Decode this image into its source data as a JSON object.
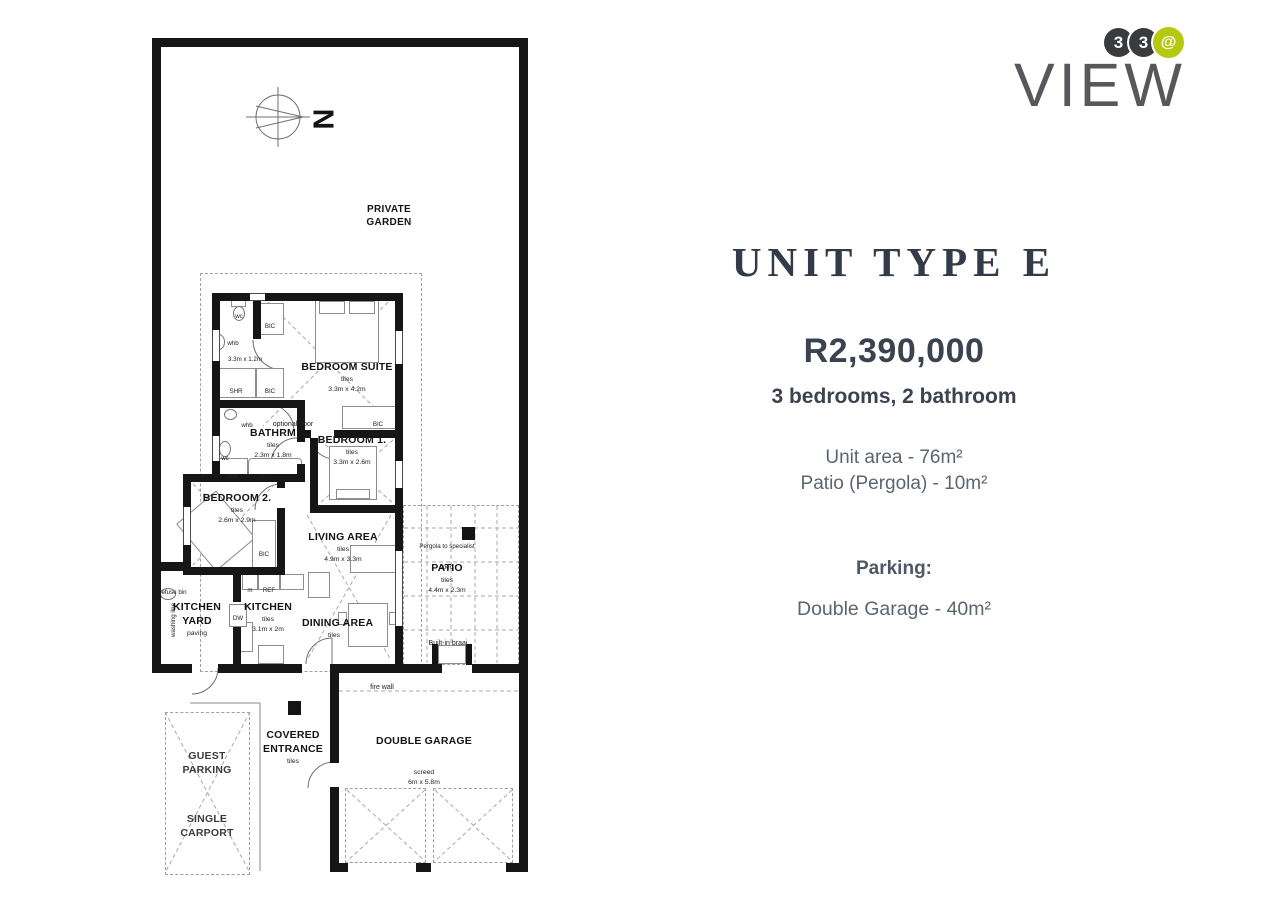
{
  "logo": {
    "badge1": "3",
    "badge2": "3",
    "badge3": "@",
    "name": "VIEW",
    "colors": {
      "dark": "#3a3b3d",
      "lime": "#b5c90f",
      "gray": "#56585c"
    }
  },
  "panel": {
    "title": "UNIT TYPE E",
    "price": "R2,390,000",
    "config": "3 bedrooms, 2 bathroom",
    "unit_area": "Unit area - 76m²",
    "patio_area": "Patio (Pergola) - 10m²",
    "parking_label": "Parking:",
    "parking_value": "Double Garage - 40m²"
  },
  "plan": {
    "compass": "N",
    "garden": "PRIVATE GARDEN",
    "fire_wall": "fire wall",
    "optional_door": "optional door",
    "rooms": {
      "suite": {
        "name": "BEDROOM SUITE",
        "finish": "tiles",
        "dim": "3.3m x 4.2m"
      },
      "ensuite": {
        "wc": "wc",
        "whb": "whb",
        "dim": "3.3m x 1.2m",
        "shr": "SHR",
        "bic": "BIC",
        "bic_top": "BIC"
      },
      "bathroom": {
        "name": "BATHRM",
        "finish": "tiles",
        "dim": "2.3m x 1.8m",
        "whb": "whb",
        "wc": "wc",
        "shr": "SHR",
        "bath": "B"
      },
      "bedroom1": {
        "name": "BEDROOM 1.",
        "finish": "tiles",
        "dim": "3.3m x 2.6m",
        "bic": "BIC"
      },
      "bedroom2": {
        "name": "BEDROOM 2.",
        "finish": "tiles",
        "dim": "2.6m x 2.9m",
        "bic": "BIC"
      },
      "living": {
        "name": "LIVING AREA",
        "finish": "tiles",
        "dim": "4.9m x 3.3m"
      },
      "dining": {
        "name": "DINING AREA",
        "finish": "tiles"
      },
      "kitchen": {
        "name": "KITCHEN",
        "finish": "tiles",
        "dim": "3.1m x 2m",
        "ref": "REF",
        "micro": "m",
        "dw": "DW"
      },
      "yard": {
        "name": "KITCHEN YARD",
        "finish": "paving",
        "refuse": "refuse bin",
        "washing": "washing line"
      },
      "patio": {
        "name": "PATIO",
        "finish": "tiles",
        "dim": "4.4m x 2.3m",
        "pergola": "Pergola to specialist spec.",
        "braai": "Built-in braai"
      },
      "garage": {
        "name": "DOUBLE GARAGE",
        "finish": "screed",
        "dim": "6m x 5.8m"
      },
      "entrance": {
        "name": "COVERED ENTRANCE",
        "finish": "tiles"
      },
      "guest": {
        "name": "GUEST PARKING",
        "type": "SINGLE CARPORT"
      }
    }
  }
}
